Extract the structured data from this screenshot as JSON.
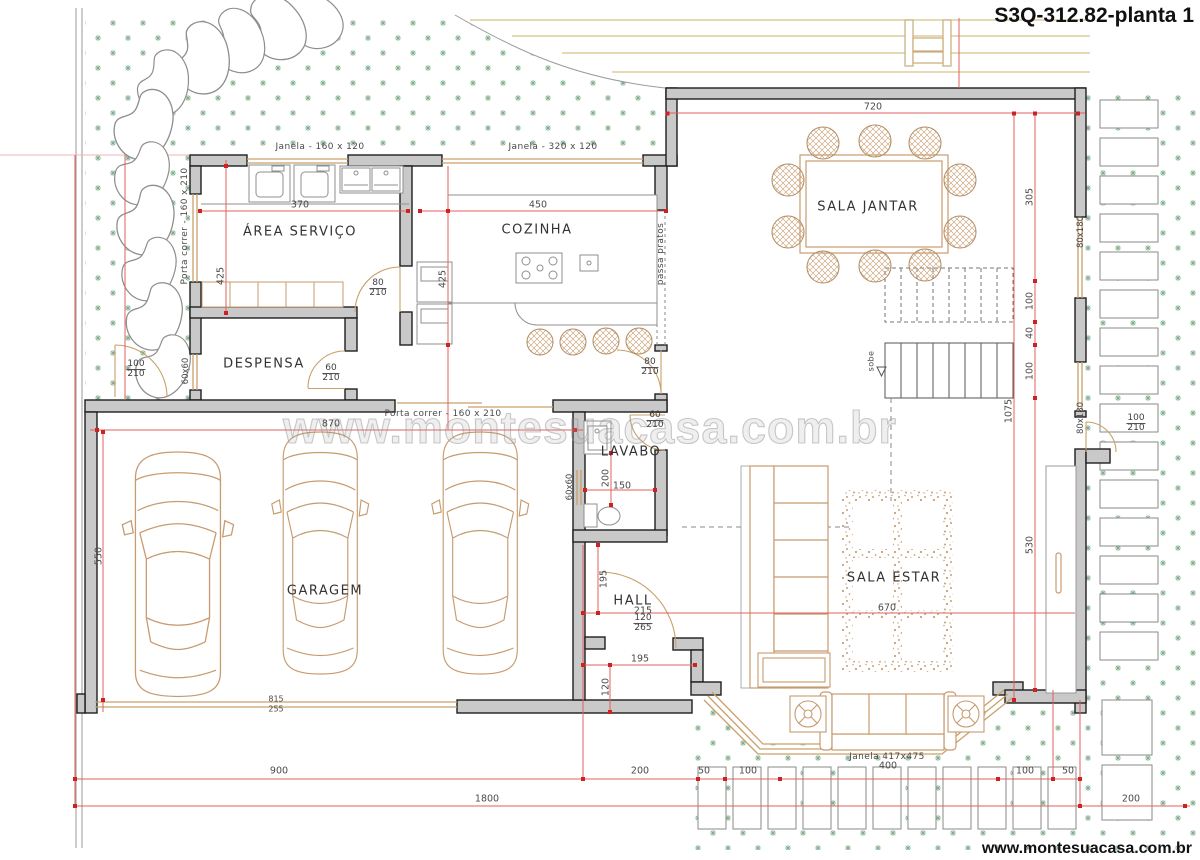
{
  "title": "S3Q-312.82-planta 1",
  "website": "www.montesuacasa.com.br",
  "watermark": "www.montesuacasa.com.br",
  "colors": {
    "wall_fill": "#c9c9c9",
    "wall_stroke": "#1e1e1e",
    "furniture_tan": "#c79b6f",
    "counter_gray": "#8f8f8f",
    "dim_red": "#e06060",
    "marker_red": "#cc2222",
    "grass_green": "#7fae8c",
    "driveway_tan": "#d8c489",
    "text_dark": "#3c3c3c"
  },
  "rooms": [
    {
      "name": "room-label-area-servico",
      "label": "ÁREA SERVIÇO",
      "x": 300,
      "y": 232
    },
    {
      "name": "room-label-cozinha",
      "label": "COZINHA",
      "x": 537,
      "y": 230
    },
    {
      "name": "room-label-despensa",
      "label": "DESPENSA",
      "x": 264,
      "y": 364
    },
    {
      "name": "room-label-sala-jantar",
      "label": "SALA JANTAR",
      "x": 868,
      "y": 207
    },
    {
      "name": "room-label-garagem",
      "label": "GARAGEM",
      "x": 325,
      "y": 591
    },
    {
      "name": "room-label-lavabo",
      "label": "LAVABO",
      "x": 631,
      "y": 452
    },
    {
      "name": "room-label-hall",
      "label": "HALL",
      "x": 633,
      "y": 601
    },
    {
      "name": "room-label-sala-estar",
      "label": "SALA ESTAR",
      "x": 894,
      "y": 578
    }
  ],
  "openings": [
    {
      "name": "window-label-janela-160x120",
      "label": "Janela - 160 x 120",
      "x": 320,
      "y": 147,
      "rot": 0,
      "size": 9
    },
    {
      "name": "window-label-janela-320x120",
      "label": "Janela - 320 x 120",
      "x": 553,
      "y": 147,
      "rot": 0,
      "size": 9
    },
    {
      "name": "door-label-porta-correr-left",
      "label": "Porta correr - 160 x 210",
      "x": 185,
      "y": 226,
      "rot": -90,
      "size": 9
    },
    {
      "name": "door-label-porta-correr-garagem",
      "label": "Porta correr - 160 x 210",
      "x": 443,
      "y": 414,
      "rot": 0,
      "size": 9
    },
    {
      "name": "window-label-janela-bay",
      "label": "Janela 417x475",
      "x": 887,
      "y": 757,
      "rot": 0,
      "size": 9
    },
    {
      "name": "pass-through-label",
      "label": "passa pratos",
      "x": 661,
      "y": 254,
      "rot": -90,
      "size": 9
    },
    {
      "name": "stairs-up-label",
      "label": "sobe",
      "x": 871,
      "y": 361,
      "rot": -90,
      "size": 8
    }
  ],
  "dims": [
    {
      "name": "dim-720",
      "text": "720",
      "x": 873,
      "y": 107
    },
    {
      "name": "dim-370",
      "text": "370",
      "x": 300,
      "y": 205
    },
    {
      "name": "dim-450",
      "text": "450",
      "x": 538,
      "y": 205
    },
    {
      "name": "dim-870",
      "text": "870",
      "x": 331,
      "y": 424
    },
    {
      "name": "dim-815",
      "text": "815",
      "x": 276,
      "y": 699,
      "size": 8
    },
    {
      "name": "dim-255",
      "text": "255",
      "x": 276,
      "y": 709,
      "size": 8
    },
    {
      "name": "dim-150",
      "text": "150",
      "x": 622,
      "y": 486
    },
    {
      "name": "dim-195-hall",
      "text": "195",
      "x": 640,
      "y": 659
    },
    {
      "name": "dim-215",
      "text": "215",
      "x": 643,
      "y": 611
    },
    {
      "name": "dim-670",
      "text": "670",
      "x": 887,
      "y": 608
    },
    {
      "name": "dim-900",
      "text": "900",
      "x": 279,
      "y": 771
    },
    {
      "name": "dim-200-terrace",
      "text": "200",
      "x": 640,
      "y": 771
    },
    {
      "name": "dim-50-left",
      "text": "50",
      "x": 704,
      "y": 771
    },
    {
      "name": "dim-100-left",
      "text": "100",
      "x": 748,
      "y": 771
    },
    {
      "name": "dim-400",
      "text": "400",
      "x": 888,
      "y": 766
    },
    {
      "name": "dim-100-right",
      "text": "100",
      "x": 1025,
      "y": 771
    },
    {
      "name": "dim-50-right",
      "text": "50",
      "x": 1068,
      "y": 771
    },
    {
      "name": "dim-1800",
      "text": "1800",
      "x": 487,
      "y": 799
    },
    {
      "name": "dim-200-lot",
      "text": "200",
      "x": 1131,
      "y": 799
    },
    {
      "name": "dim-425-servico",
      "text": "425",
      "x": 221,
      "y": 276,
      "rot": -90
    },
    {
      "name": "dim-425-cozinha",
      "text": "425",
      "x": 443,
      "y": 279,
      "rot": -90
    },
    {
      "name": "dim-550",
      "text": "550",
      "x": 99,
      "y": 556,
      "rot": -90
    },
    {
      "name": "dim-305",
      "text": "305",
      "x": 1030,
      "y": 197,
      "rot": -90
    },
    {
      "name": "dim-100-stairs-a",
      "text": "100",
      "x": 1030,
      "y": 301,
      "rot": -90
    },
    {
      "name": "dim-40",
      "text": "40",
      "x": 1030,
      "y": 333,
      "rot": -90
    },
    {
      "name": "dim-100-stairs-b",
      "text": "100",
      "x": 1030,
      "y": 371,
      "rot": -90
    },
    {
      "name": "dim-1075",
      "text": "1075",
      "x": 1009,
      "y": 411,
      "rot": -90
    },
    {
      "name": "dim-530",
      "text": "530",
      "x": 1030,
      "y": 545,
      "rot": -90
    },
    {
      "name": "dim-200-lavabo",
      "text": "200",
      "x": 606,
      "y": 478,
      "rot": -90
    },
    {
      "name": "dim-195-hall-v",
      "text": "195",
      "x": 604,
      "y": 579,
      "rot": -90
    },
    {
      "name": "dim-120-hall",
      "text": "120",
      "x": 606,
      "y": 687,
      "rot": -90
    }
  ],
  "window_tags": [
    {
      "name": "window-tag-60x60-despensa",
      "text": "60x60",
      "x": 186,
      "y": 371
    },
    {
      "name": "window-tag-60x60-lavabo",
      "text": "60x60",
      "x": 570,
      "y": 487
    },
    {
      "name": "window-tag-80x180-top",
      "text": "80x180",
      "x": 1081,
      "y": 232
    },
    {
      "name": "window-tag-80x180-bottom",
      "text": "80x180",
      "x": 1081,
      "y": 418
    }
  ],
  "door_tags": [
    {
      "name": "door-tag-80-210-servico",
      "top": "80",
      "bottom": "210",
      "x": 378,
      "y": 289
    },
    {
      "name": "door-tag-60-210-despensa",
      "top": "60",
      "bottom": "210",
      "x": 331,
      "y": 374
    },
    {
      "name": "door-tag-100-210-garden",
      "top": "100",
      "bottom": "210",
      "x": 136,
      "y": 370
    },
    {
      "name": "door-tag-80-210-cozinha",
      "top": "80",
      "bottom": "210",
      "x": 650,
      "y": 368
    },
    {
      "name": "door-tag-60-210-lavabo",
      "top": "60",
      "bottom": "210",
      "x": 655,
      "y": 421
    },
    {
      "name": "door-tag-100-210-right",
      "top": "100",
      "bottom": "210",
      "x": 1136,
      "y": 424
    },
    {
      "name": "door-tag-120-265-hall",
      "top": "120",
      "bottom": "265",
      "x": 643,
      "y": 624
    }
  ]
}
